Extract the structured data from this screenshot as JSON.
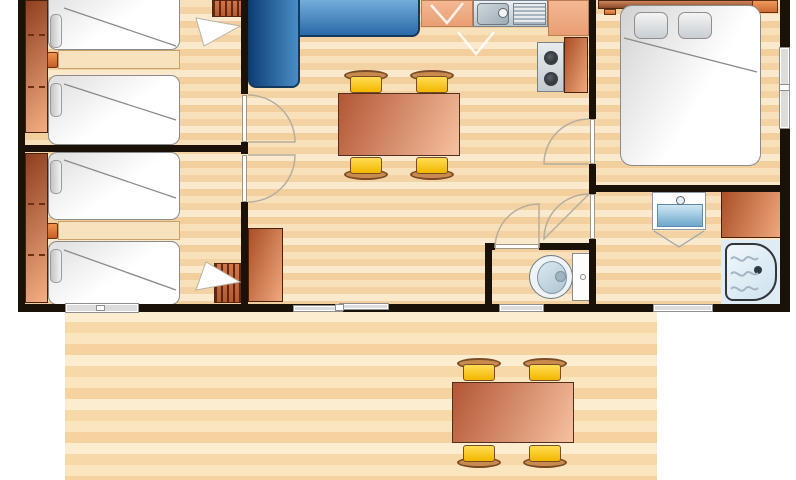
{
  "floor_plan": {
    "kind": "mobile-home floor plan with terrace, top-down view, no text labels",
    "palette": {
      "wall": "#1a1208",
      "floor_light": "#fae9cd",
      "floor_dark": "#f3cf9d",
      "deck_light": "#fdedd0",
      "deck_dark": "#f6d2a0",
      "sofa_blue": "#2a6aa8",
      "table_salmon": "#d98a62",
      "chair_yellow": "#ffd23e",
      "cabinet_orange": "#c96a3f",
      "fixture_blue": "#bcd9ec",
      "bed_white": "#ffffff",
      "pillow_gray": "#d2d2d2",
      "window_gray": "#dcdcdc",
      "stainless": "#c3cbd1"
    },
    "rooms": {
      "bedroom_top_left": "Twin bedroom (top left) with two single beds and wardrobe",
      "bedroom_bottom_left": "Twin bedroom (bottom left) with two single beds and wardrobe",
      "living_kitchen": "Open living room and kitchen with corner sofa and dining table",
      "wc": "Separate WC with toilet",
      "bathroom": "Bathroom with washbasin, cabinet and bathtub-shower",
      "bedroom_right": "Double bedroom with double bed and headboard shelf",
      "terrace": "Wooden terrace deck with outdoor dining table"
    },
    "furniture": {
      "wardrobe": "Wardrobe",
      "single_bed": "Single bed",
      "pillow": "Pillow",
      "bedside_shelf": "Bedside shelf",
      "drawer_handle": "Drawer handle",
      "radiator": "Radiator",
      "sofa": "Blue corner sofa",
      "dining_table": "Dining table",
      "chair": "Dining chair",
      "storage_cabinet": "Storage cabinet",
      "kitchen_counter": "Kitchen counter",
      "kitchen_sink": "Kitchen sink with drainer",
      "hob": "Two-burner hob",
      "kitchen_cabinet": "Kitchen cabinet",
      "toilet": "Toilet",
      "cistern": "Toilet cistern",
      "washbasin": "Washbasin",
      "bathroom_cabinet": "Bathroom cabinet",
      "bathtub": "Bathtub / shower",
      "double_bed": "Double bed",
      "headboard_shelf": "Headboard shelf",
      "window": "Window",
      "sliding_door": "Sliding patio door",
      "door": "Interior door",
      "terrace_table": "Terrace table",
      "terrace_chair": "Terrace chair",
      "deck": "Terrace deck"
    }
  }
}
